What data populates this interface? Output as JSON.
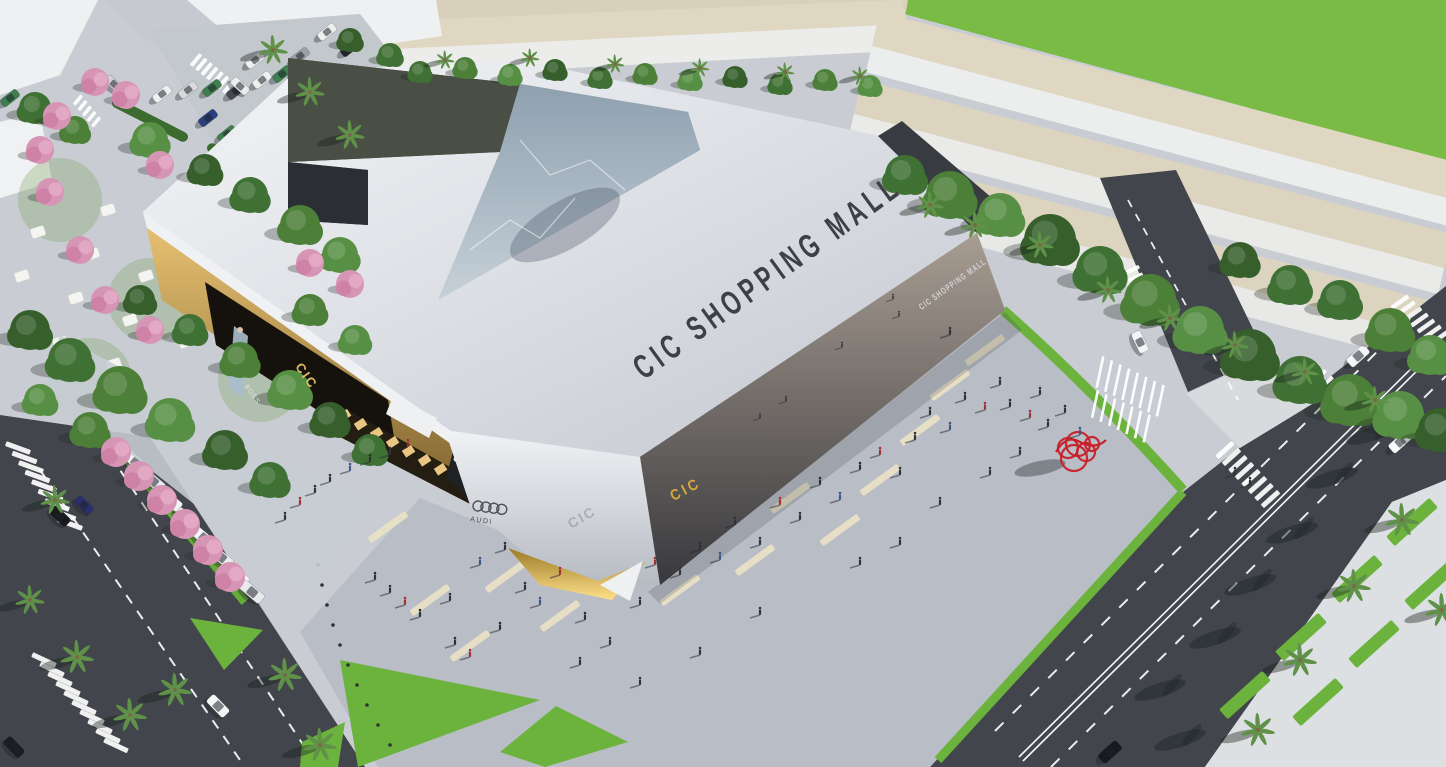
{
  "scene_title": "CIC Shopping Mall — aerial architectural render",
  "signs": {
    "roof": "CIC SHOPPING MALL",
    "right_facade": "CIC SHOPPING MALL",
    "front_glass": "CIC",
    "left_facade": "CIC",
    "glass_reflection": "CIC",
    "billboard": "BOSS",
    "audi": {
      "brand": "AUDI",
      "rings": 4
    }
  },
  "palette": {
    "roof": "#e8eaee",
    "roof_sign_text": "#3d4146",
    "dark_glass_facade": "#4a443e",
    "gold_facade": "#c9a054",
    "gold_sign": "#d7a93f",
    "plaza_paving": "#b9bec6",
    "beige_paver": "#e8e0c6",
    "asphalt": "#42464c",
    "road_marking": "#ffffff",
    "grass": "#6cb33e",
    "field": "#79bb44",
    "tree_green": "#4c7c3a",
    "palm_green": "#5f9148",
    "pink_tree": "#d795b5",
    "sculpture_red": "#c8202a",
    "car_white": "#f2f3f4"
  }
}
